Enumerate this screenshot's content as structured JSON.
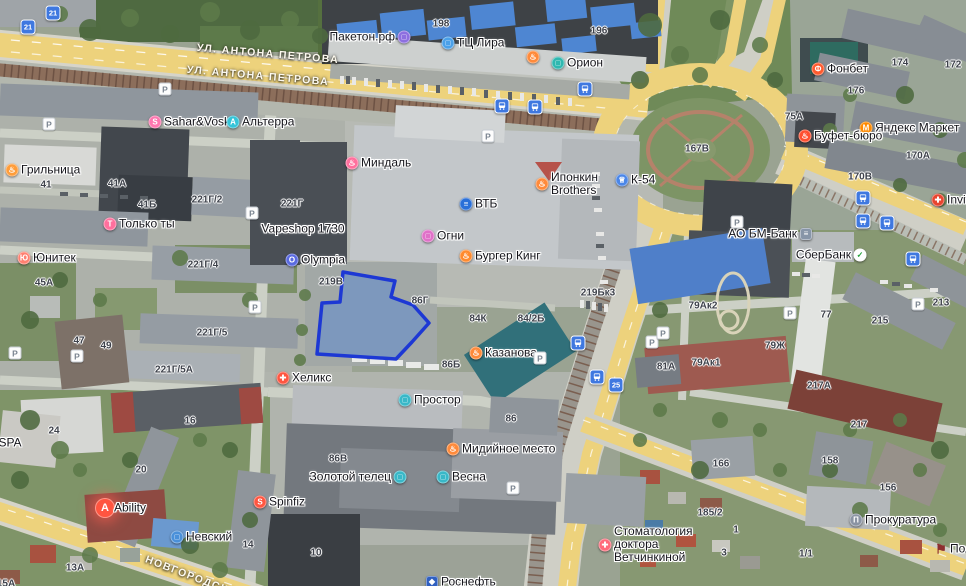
{
  "map": {
    "selection": {
      "points": "343,272 395,281 391,297 413,305 429,323 412,342 396,359 317,354 322,303 340,302",
      "fill": "rgba(86,136,216,0.48)",
      "stroke": "#1d38d4"
    },
    "streets": [
      {
        "label": "УЛ. АНТОНА ПЕТРОВА",
        "x": 268,
        "y": 54,
        "rotate": 5
      },
      {
        "label": "УЛ. АНТОНА ПЕТРОВА",
        "x": 258,
        "y": 76,
        "rotate": 5
      },
      {
        "label": "НОВГОРОДСКАЯ",
        "x": 195,
        "y": 578,
        "rotate": 21
      }
    ],
    "pois": [
      {
        "label": "Пакетон.рф",
        "x": 404,
        "y": 37,
        "color": "#8d6fe0",
        "glyph": "bag",
        "side": "left"
      },
      {
        "label": "ТЦ Лира",
        "x": 448,
        "y": 43,
        "color": "#4aa0e8",
        "glyph": "bag",
        "side": "right"
      },
      {
        "label": "Орион",
        "x": 558,
        "y": 63,
        "color": "#2fb8b0",
        "glyph": "bag",
        "side": "right"
      },
      {
        "label": "",
        "x": 533,
        "y": 57,
        "color": "#ff8a3a",
        "glyph": "food",
        "side": "right"
      },
      {
        "label": "Фонбет",
        "x": 818,
        "y": 69,
        "color": "#ff5a2e",
        "glyph": "letter-Ф",
        "side": "right"
      },
      {
        "label": "Яндекс Маркет",
        "x": 866,
        "y": 128,
        "color": "#ff8a00",
        "glyph": "letter-М",
        "side": "right"
      },
      {
        "label": "Буфет-бюро",
        "x": 805,
        "y": 136,
        "color": "#ff4f30",
        "glyph": "food",
        "side": "right"
      },
      {
        "label": "Invit",
        "x": 938,
        "y": 200,
        "color": "#e8442e",
        "glyph": "medical-cross",
        "side": "right"
      },
      {
        "label": "Sahar&Vosk",
        "x": 155,
        "y": 122,
        "color": "#ff77b0",
        "glyph": "letter-S",
        "side": "right"
      },
      {
        "label": "Альтерра",
        "x": 233,
        "y": 122,
        "color": "#35c4d8",
        "glyph": "letter-А",
        "side": "right"
      },
      {
        "label": "Грильница",
        "x": 12,
        "y": 170,
        "color": "#ff9d3a",
        "glyph": "food",
        "side": "right"
      },
      {
        "label": "Только ты",
        "x": 110,
        "y": 224,
        "color": "#ff6f9d",
        "glyph": "letter-Т",
        "side": "right"
      },
      {
        "label": "Юнитек",
        "x": 24,
        "y": 258,
        "color": "#ff8070",
        "glyph": "letter-Ю",
        "side": "right"
      },
      {
        "label": "Vapeshop 1730",
        "x": 303,
        "y": 229,
        "color": "",
        "glyph": "none",
        "side": "center"
      },
      {
        "label": "Olympia",
        "x": 292,
        "y": 260,
        "color": "#5a6ae0",
        "glyph": "letter-O",
        "side": "right"
      },
      {
        "label": "Миндаль",
        "x": 352,
        "y": 163,
        "color": "#ff6f9d",
        "glyph": "food",
        "side": "right"
      },
      {
        "label": "ВТБ",
        "x": 466,
        "y": 204,
        "color": "#2a6fd8",
        "glyph": "bank",
        "side": "right"
      },
      {
        "label": "Огни",
        "x": 428,
        "y": 236,
        "color": "#e070c8",
        "glyph": "bag",
        "side": "right"
      },
      {
        "label": "Бургер Кинг",
        "x": 466,
        "y": 256,
        "color": "#ff8a2e",
        "glyph": "food",
        "side": "right"
      },
      {
        "label": "Ипонкин\nBrothers",
        "x": 542,
        "y": 184,
        "color": "#ff8a3a",
        "glyph": "food",
        "side": "right"
      },
      {
        "label": "К-54",
        "x": 622,
        "y": 180,
        "color": "#4a86e8",
        "glyph": "cup",
        "side": "right"
      },
      {
        "label": "АО БМ-Банк",
        "x": 806,
        "y": 234,
        "color": "#8795a8",
        "glyph": "bank",
        "side": "left",
        "shape": "square"
      },
      {
        "label": "СберБанк",
        "x": 860,
        "y": 255,
        "color": "#ffffff",
        "glyph": "sber-check",
        "side": "left"
      },
      {
        "label": "Казанова",
        "x": 476,
        "y": 353,
        "color": "#ff8a3a",
        "glyph": "food",
        "side": "right"
      },
      {
        "label": "Хеликс",
        "x": 283,
        "y": 378,
        "color": "#ff5540",
        "glyph": "medical-cross",
        "side": "right"
      },
      {
        "label": "Простор",
        "x": 405,
        "y": 400,
        "color": "#38b8c8",
        "glyph": "bag",
        "side": "right"
      },
      {
        "label": "Мидийное место",
        "x": 453,
        "y": 449,
        "color": "#ff8a3a",
        "glyph": "food",
        "side": "right"
      },
      {
        "label": "Золотой телец",
        "x": 400,
        "y": 477,
        "color": "#38b8c8",
        "glyph": "bag",
        "side": "left"
      },
      {
        "label": "Весна",
        "x": 443,
        "y": 477,
        "color": "#38b8c8",
        "glyph": "bag",
        "side": "right"
      },
      {
        "label": "Невский",
        "x": 177,
        "y": 537,
        "color": "#4a90d9",
        "glyph": "bag",
        "side": "right"
      },
      {
        "label": "Spinfiz",
        "x": 260,
        "y": 502,
        "color": "#ff5540",
        "glyph": "letter-S",
        "side": "right"
      },
      {
        "label": "Ability",
        "x": 105,
        "y": 508,
        "color": "#ff5540",
        "glyph": "letter-A",
        "side": "right",
        "size": "large"
      },
      {
        "label": "Стоматология\nдоктора\nВетчинкиной",
        "x": 605,
        "y": 545,
        "color": "#ff6a7a",
        "glyph": "medical-cross",
        "side": "right"
      },
      {
        "label": "Прокуратура",
        "x": 856,
        "y": 520,
        "color": "#8a93a3",
        "glyph": "gov",
        "side": "right"
      },
      {
        "label": "Роснефть",
        "x": 432,
        "y": 582,
        "color": "#2f5fc0",
        "glyph": "fuel",
        "side": "right",
        "shape": "square"
      },
      {
        "label": "SPA",
        "x": 10,
        "y": 443,
        "color": "",
        "glyph": "none",
        "side": "center"
      },
      {
        "label": "Пол",
        "x": 941,
        "y": 549,
        "color": "#8d2f2f",
        "glyph": "flag",
        "side": "right",
        "shape": "flag"
      }
    ],
    "numbers": [
      {
        "t": "41",
        "x": 46,
        "y": 185
      },
      {
        "t": "41А",
        "x": 117,
        "y": 184
      },
      {
        "t": "41Б",
        "x": 147,
        "y": 205
      },
      {
        "t": "221Г/2",
        "x": 207,
        "y": 200
      },
      {
        "t": "221Г",
        "x": 292,
        "y": 204
      },
      {
        "t": "221Г/4",
        "x": 203,
        "y": 265
      },
      {
        "t": "221Г/5",
        "x": 212,
        "y": 333
      },
      {
        "t": "221Г/5А",
        "x": 174,
        "y": 370
      },
      {
        "t": "45А",
        "x": 44,
        "y": 283
      },
      {
        "t": "47",
        "x": 79,
        "y": 341
      },
      {
        "t": "49",
        "x": 106,
        "y": 346
      },
      {
        "t": "24",
        "x": 54,
        "y": 431
      },
      {
        "t": "16",
        "x": 190,
        "y": 421
      },
      {
        "t": "20",
        "x": 141,
        "y": 470
      },
      {
        "t": "14",
        "x": 248,
        "y": 545
      },
      {
        "t": "13А",
        "x": 75,
        "y": 568
      },
      {
        "t": "10",
        "x": 316,
        "y": 553
      },
      {
        "t": "15А",
        "x": 6,
        "y": 584
      },
      {
        "t": "198",
        "x": 441,
        "y": 24
      },
      {
        "t": "196",
        "x": 599,
        "y": 31
      },
      {
        "t": "167В",
        "x": 697,
        "y": 149
      },
      {
        "t": "75А",
        "x": 794,
        "y": 117
      },
      {
        "t": "174",
        "x": 900,
        "y": 63
      },
      {
        "t": "172",
        "x": 953,
        "y": 65
      },
      {
        "t": "176",
        "x": 856,
        "y": 91
      },
      {
        "t": "170А",
        "x": 918,
        "y": 156
      },
      {
        "t": "170В",
        "x": 860,
        "y": 177
      },
      {
        "t": "219В",
        "x": 331,
        "y": 282
      },
      {
        "t": "86Г",
        "x": 420,
        "y": 301
      },
      {
        "t": "84К",
        "x": 478,
        "y": 319
      },
      {
        "t": "84/2Б",
        "x": 531,
        "y": 319
      },
      {
        "t": "86Б",
        "x": 451,
        "y": 365
      },
      {
        "t": "86",
        "x": 511,
        "y": 419
      },
      {
        "t": "86В",
        "x": 338,
        "y": 459
      },
      {
        "t": "219Бк3",
        "x": 598,
        "y": 293
      },
      {
        "t": "79Ак2",
        "x": 703,
        "y": 306
      },
      {
        "t": "79Ж",
        "x": 775,
        "y": 346
      },
      {
        "t": "79Ак1",
        "x": 706,
        "y": 363
      },
      {
        "t": "81А",
        "x": 666,
        "y": 367
      },
      {
        "t": "77",
        "x": 826,
        "y": 315
      },
      {
        "t": "215",
        "x": 880,
        "y": 321
      },
      {
        "t": "213",
        "x": 941,
        "y": 303
      },
      {
        "t": "217А",
        "x": 819,
        "y": 386
      },
      {
        "t": "217",
        "x": 859,
        "y": 425
      },
      {
        "t": "158",
        "x": 830,
        "y": 461
      },
      {
        "t": "156",
        "x": 888,
        "y": 488
      },
      {
        "t": "166",
        "x": 721,
        "y": 464
      },
      {
        "t": "185/2",
        "x": 710,
        "y": 513
      },
      {
        "t": "1",
        "x": 736,
        "y": 530
      },
      {
        "t": "3",
        "x": 724,
        "y": 553
      },
      {
        "t": "1/1",
        "x": 806,
        "y": 554
      }
    ],
    "transit": {
      "routes": [
        {
          "x": 53,
          "y": 13,
          "n": "21"
        },
        {
          "x": 28,
          "y": 27,
          "n": "21"
        },
        {
          "x": 616,
          "y": 385,
          "n": "25"
        }
      ],
      "stops": [
        {
          "x": 502,
          "y": 106
        },
        {
          "x": 535,
          "y": 107
        },
        {
          "x": 585,
          "y": 89
        },
        {
          "x": 863,
          "y": 198
        },
        {
          "x": 863,
          "y": 221
        },
        {
          "x": 887,
          "y": 223
        },
        {
          "x": 913,
          "y": 259
        },
        {
          "x": 578,
          "y": 343
        },
        {
          "x": 597,
          "y": 377
        }
      ]
    },
    "parking_glyph": "P",
    "parking": [
      {
        "x": 49,
        "y": 124
      },
      {
        "x": 165,
        "y": 89
      },
      {
        "x": 252,
        "y": 213
      },
      {
        "x": 255,
        "y": 307
      },
      {
        "x": 77,
        "y": 356
      },
      {
        "x": 15,
        "y": 353
      },
      {
        "x": 540,
        "y": 358
      },
      {
        "x": 737,
        "y": 222
      },
      {
        "x": 790,
        "y": 313
      },
      {
        "x": 918,
        "y": 304
      },
      {
        "x": 652,
        "y": 342
      },
      {
        "x": 513,
        "y": 488
      },
      {
        "x": 488,
        "y": 136
      },
      {
        "x": 663,
        "y": 333
      }
    ]
  }
}
